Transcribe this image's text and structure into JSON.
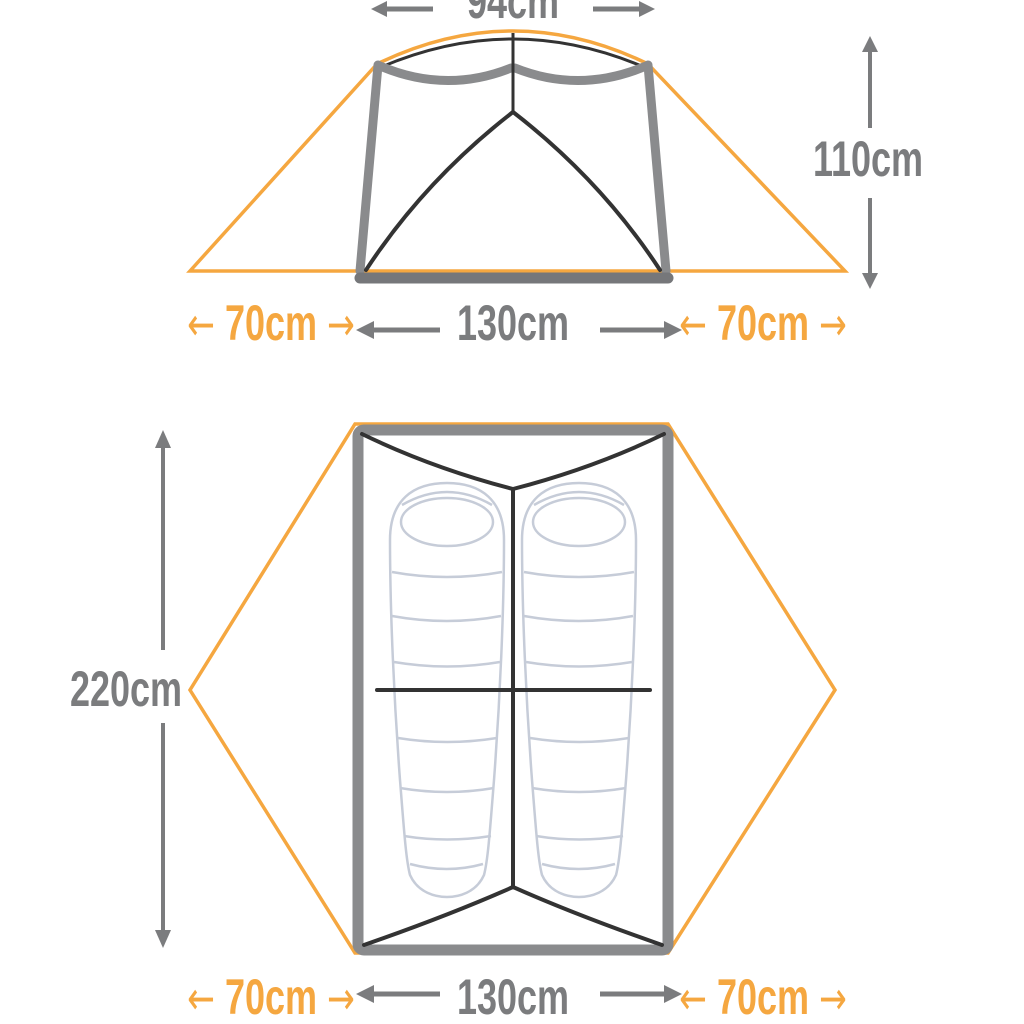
{
  "diagram_title": "Tent dimensions diagram (front elevation and floor plan)",
  "colors": {
    "orange_accent": "#F5A740",
    "gray_text": "#7B7C7E",
    "frame_gray": "#8A8B8D",
    "floor_gray": "#76777A",
    "line_black": "#333333",
    "sleeping_bag_outline": "#C6CCD8"
  },
  "icons": {
    "arrow_left": "←",
    "arrow_right": "→"
  },
  "front_view": {
    "top_width": {
      "label": "94cm"
    },
    "height": {
      "label": "110cm"
    },
    "bottom_row": {
      "left_vestibule": {
        "left_arrow": "←",
        "label": "70cm",
        "right_arrow": "→"
      },
      "floor_width": {
        "label": "130cm"
      },
      "right_vestibule": {
        "left_arrow": "←",
        "label": "70cm",
        "right_arrow": "→"
      }
    }
  },
  "floor_plan": {
    "length": {
      "label": "220cm"
    },
    "bottom_row": {
      "left_vestibule": {
        "left_arrow": "←",
        "label": "70cm",
        "right_arrow": "→"
      },
      "floor_width": {
        "label": "130cm"
      },
      "right_vestibule": {
        "left_arrow": "←",
        "label": "70cm",
        "right_arrow": "→"
      }
    }
  }
}
